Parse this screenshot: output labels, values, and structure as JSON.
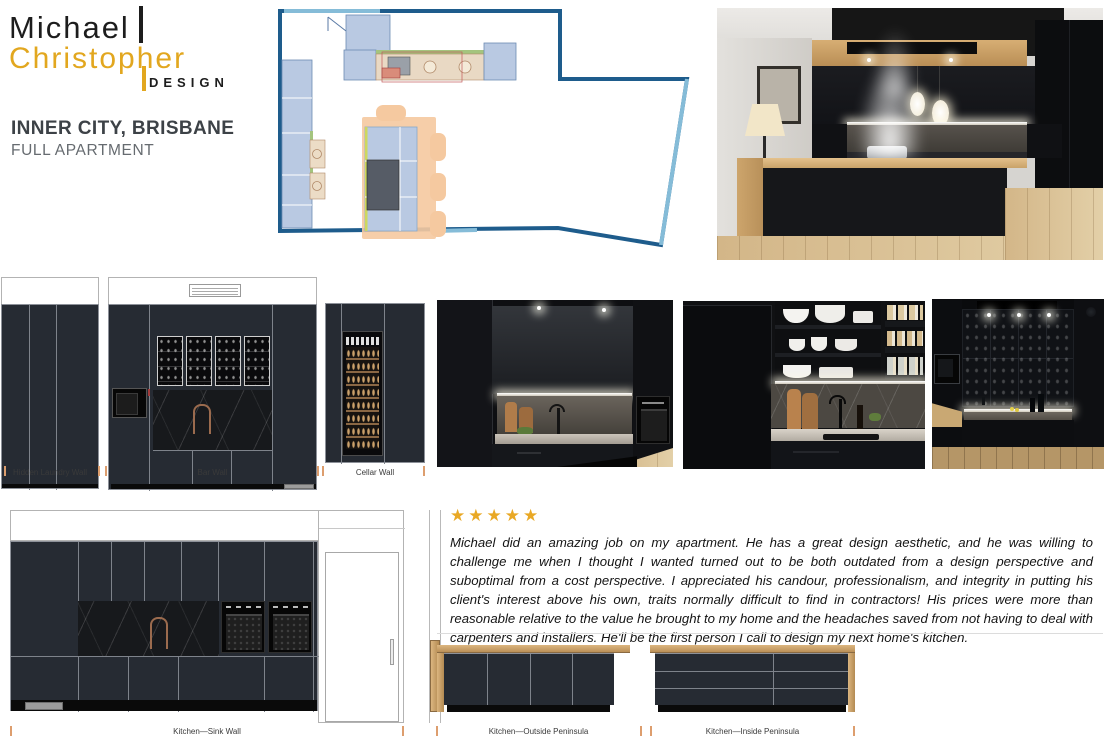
{
  "brand": {
    "word1": "Michael",
    "word2": "Christopher",
    "word3": "DESIGN"
  },
  "project": {
    "title": "INNER CITY, BRISBANE",
    "subtitle": "FULL APARTMENT"
  },
  "labels": {
    "hidden_laundry": "Hidden Laundry Wall",
    "bar": "Bar Wall",
    "cellar": "Cellar Wall",
    "sink": "Kitchen—Sink Wall",
    "outside_peninsula": "Kitchen—Outside Peninsula",
    "inside_peninsula": "Kitchen—Inside Peninsula"
  },
  "review": {
    "stars_count": 5,
    "stars_text": "★★★★★",
    "text": "Michael did an amazing job on my apartment. He has a great design aesthetic, and he was willing to challenge me when I thought I wanted turned out to be both outdated from a design perspective and suboptimal from a cost perspective. I appreciated his candour, professionalism, and integrity in putting his client's interest above his own, traits normally difficult to find in contractors! His prices were more than reasonable relative to the value he brought to my home and the headaches saved from not having to deal with carpenters and installers. He'll be the first person I call to design my next home's kitchen."
  },
  "colors": {
    "brand_gold": "#e2a71f",
    "star_gold": "#e9a825",
    "cabinet_dark": "#262b33",
    "benchtop_wood": "#c9a269",
    "plan_wall_blue": "#1e5c8c",
    "plan_window_blue": "#85bcd8",
    "plan_cabinet_blue": "#b9c9e2",
    "plan_island_peach": "#f5c9a0",
    "dimension_tick_orange": "#dd9e6e"
  }
}
